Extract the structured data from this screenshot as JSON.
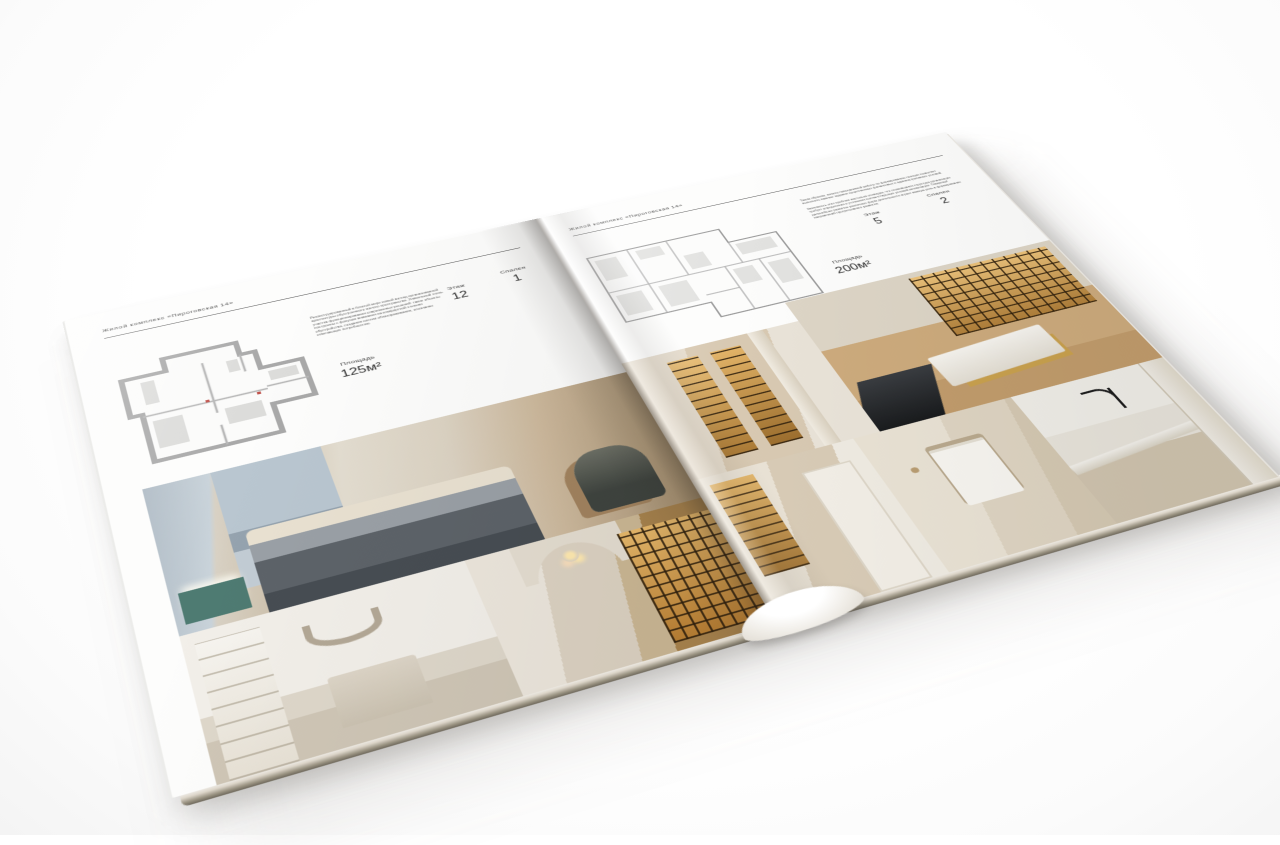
{
  "scene": {
    "subject": "open-interior-brochure-mockup",
    "background_color": "#ffffff"
  },
  "palette": {
    "paper": "#fdfdfc",
    "ink": "#3a3a3a",
    "beige": "#d8cbb6",
    "amber_shelf": "#c9963f",
    "teal_accent": "#4e7b72",
    "dark_furniture": "#474d53",
    "page_edge": "#6e685c"
  },
  "left_page": {
    "header": "Жилой комплекс «Пироговская 14»",
    "description": "Реконструированный в богатой мере новый взгляд организованной архитектуры обустроенного жилого пространства. Уникальный стиль участка функционирования современных решений: такие объекты построены с фокусом внимания на комфортной степени обустройства, создания систем облагораживания, осознанно отвечающих потребностям.",
    "stats": [
      {
        "label": "Площадь",
        "value": "125м²"
      },
      {
        "label": "Этаж",
        "value": "12"
      },
      {
        "label": "Спален",
        "value": "1"
      }
    ],
    "floor_plan": "apartment-plan-125m2",
    "photos": [
      "master-bedroom-render",
      "arched-niche-bedroom-render",
      "gallery-hall-with-bookcase-render"
    ]
  },
  "right_page": {
    "header": "Жилой комплекс «Пироговская 14»",
    "description_1": "Таким образом, начало повседневной работы по формированию позиции позволяет выполнить важные задания существенных финансовых и административных условий.",
    "description_2": "Значимость этих проблем настолько очевидна, что сложившаяся структура организации требует определения и уточнения соответствующих условий активизации. Товарищи! дальнейшее развитие различных форм деятельности играет важную роль в формировании направлений прогрессивного развития.",
    "stats": [
      {
        "label": "Площадь",
        "value": "200м²"
      },
      {
        "label": "Этаж",
        "value": "5"
      },
      {
        "label": "Спален",
        "value": "2"
      }
    ],
    "floor_plan": "apartment-plan-200m2",
    "photos": [
      "lit-display-cabinet-hall-render",
      "study-with-bookshelf-wall-render",
      "closet-corridor-render",
      "bathroom-towel-wall-render",
      "kitchen-island-faucet-render"
    ]
  }
}
